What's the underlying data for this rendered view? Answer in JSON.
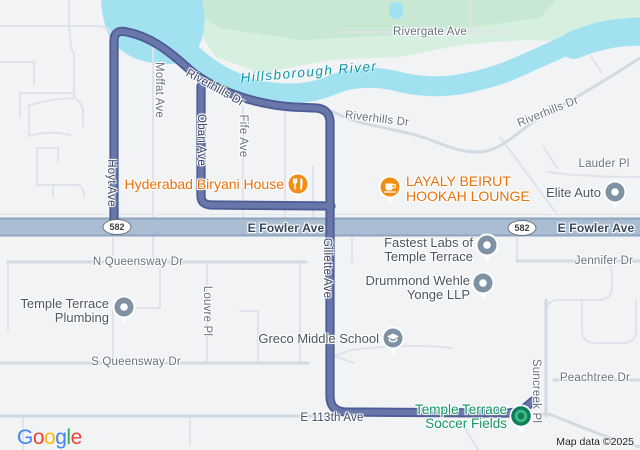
{
  "map": {
    "provider_logo": [
      "G",
      "o",
      "o",
      "g",
      "l",
      "e"
    ],
    "attribution": "Map data ©2025",
    "route_shield": "582"
  },
  "streets": {
    "rivergate": "Rivergate Ave",
    "riverhills": "Riverhills Dr",
    "moffat": "Moffat Ave",
    "oban": "Oban Ave",
    "fife": "Fife Ave",
    "hoyt": "Hoyt Ave",
    "gillette": "Gillette Ave",
    "fowler": "E Fowler Ave",
    "lauder": "Lauder Pl",
    "jennifer": "Jennifer Dr",
    "n_queensway": "N Queensway Dr",
    "s_queensway": "S Queensway Dr",
    "louvre": "Louvre Pl",
    "suncreek": "Suncreek Pl",
    "peachtree": "Peachtree Dr",
    "e113": "E 113th Ave"
  },
  "water": {
    "river": "Hillsborough River"
  },
  "pois": {
    "hyderabad": {
      "name": "Hyderabad Biryani House"
    },
    "layaly": {
      "line1": "LAYALY BEIRUT",
      "line2": "HOOKAH LOUNGE"
    },
    "elite": {
      "name": "Elite Auto"
    },
    "fastest": {
      "line1": "Fastest Labs of",
      "line2": "Temple Terrace"
    },
    "drummond": {
      "line1": "Drummond Wehle",
      "line2": "Yonge LLP"
    },
    "greco": {
      "name": "Greco Middle School"
    },
    "plumbing": {
      "line1": "Temple Terrace",
      "line2": "Plumbing"
    },
    "soccer": {
      "line1": "Temple Terrace",
      "line2": "Soccer Fields"
    }
  },
  "colors": {
    "route": "#5a689d",
    "water": "#a2e2f0",
    "park": "#d6efdf",
    "highway_fill": "#aabdd2",
    "poi_orange_text": "#e8710a",
    "poi_green_text": "#109862",
    "pin_gray": "#7e92a3",
    "pin_orange": "#f28e13",
    "destination_teal": "#0f7e58"
  }
}
